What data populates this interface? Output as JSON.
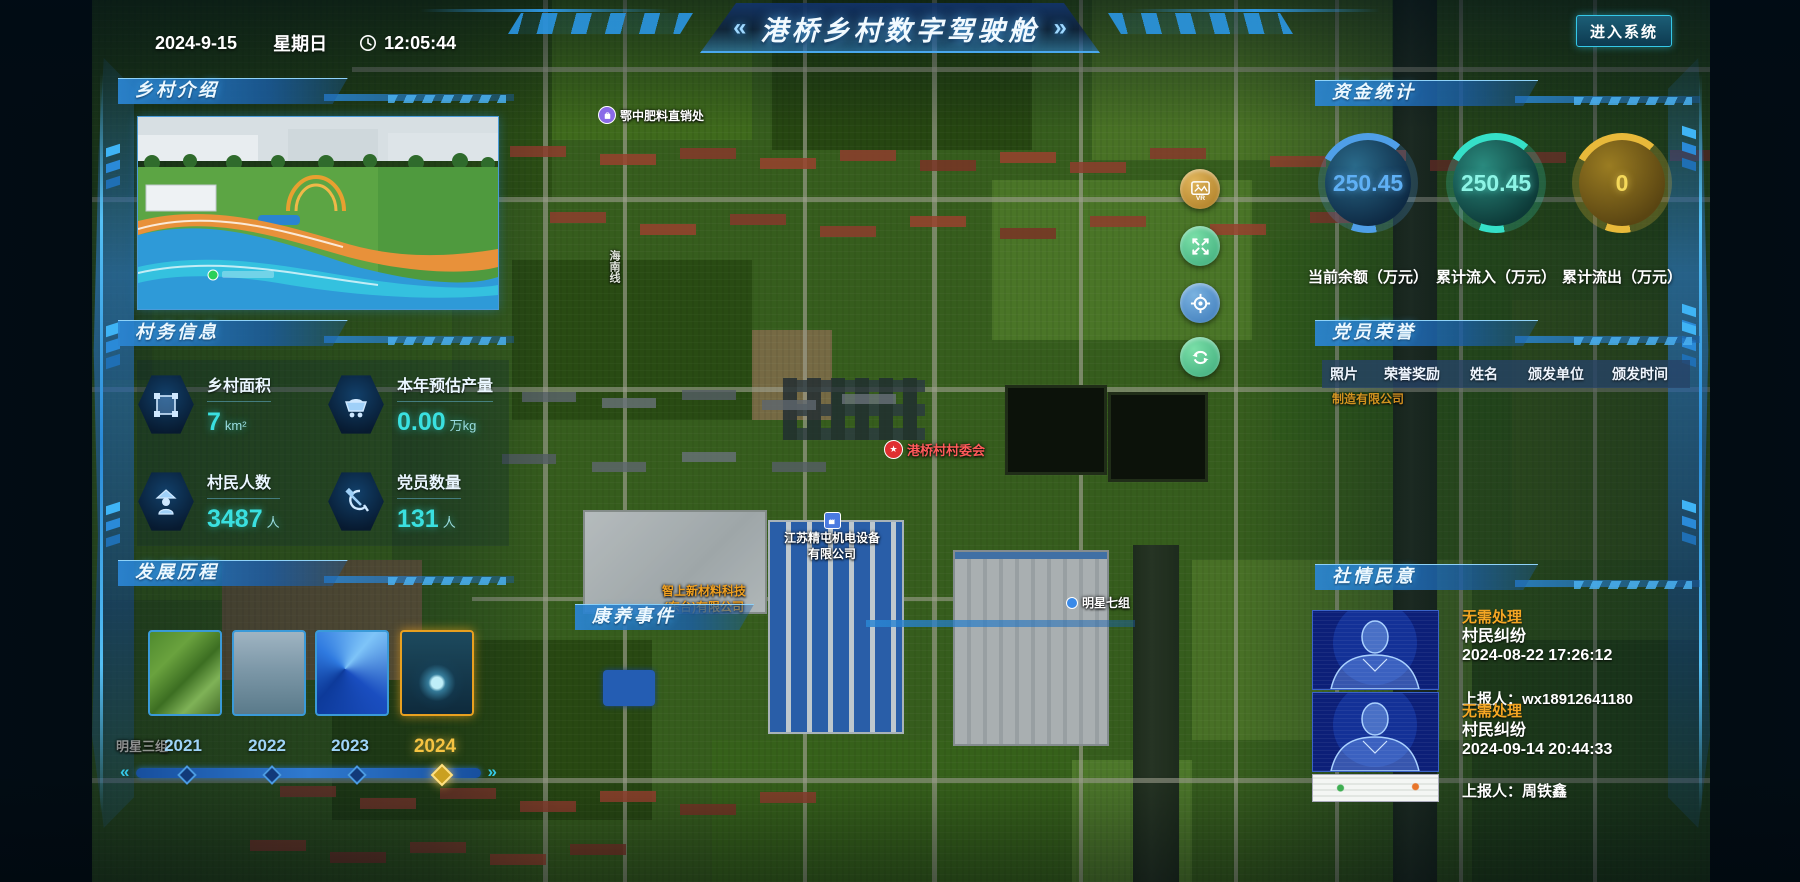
{
  "header": {
    "date": "2024-9-15",
    "weekday": "星期日",
    "time": "12:05:44",
    "left_arrow": "«",
    "title": "港桥乡村数字驾驶舱",
    "right_arrow": "»",
    "enter_button": "进入系统"
  },
  "intro": {
    "title": "乡村介绍"
  },
  "affairs": {
    "title": "村务信息",
    "stats": [
      {
        "icon": "area-icon",
        "label": "乡村面积",
        "value": "7",
        "unit": "km²"
      },
      {
        "icon": "cart-icon",
        "label": "本年预估产量",
        "value": "0.00",
        "unit": "万kg"
      },
      {
        "icon": "villager-icon",
        "label": "村民人数",
        "value": "3487",
        "unit": "人"
      },
      {
        "icon": "party-icon",
        "label": "党员数量",
        "value": "131",
        "unit": "人"
      }
    ]
  },
  "history": {
    "title": "发展历程",
    "items": [
      {
        "year": "2021"
      },
      {
        "year": "2022"
      },
      {
        "year": "2023"
      },
      {
        "year": "2024",
        "active": true
      }
    ]
  },
  "funds": {
    "title": "资金统计",
    "gauges": [
      {
        "value": "250.45",
        "label": "当前余额（万元）",
        "color": "#4f9fe8"
      },
      {
        "value": "250.45",
        "label": "累计流入（万元）",
        "color": "#35e0c8"
      },
      {
        "value": "0",
        "label": "累计流出（万元）",
        "color": "#e8b93a"
      }
    ]
  },
  "honors": {
    "title": "党员荣誉",
    "columns": [
      "照片",
      "荣誉奖励",
      "姓名",
      "颁发单位",
      "颁发时间"
    ]
  },
  "sentiment": {
    "title": "社情民意",
    "status_color": "#f5a623",
    "items": [
      {
        "status": "无需处理",
        "category": "村民纠纷",
        "time": "2024-08-22 17:26:12",
        "reporter": "上报人：wx18912641180"
      },
      {
        "status": "无需处理",
        "category": "村民纠纷",
        "time": "2024-09-14 20:44:33",
        "reporter": "上报人：周铁鑫"
      }
    ]
  },
  "health": {
    "title": "康养事件"
  },
  "map": {
    "pois": [
      {
        "text": "鄂中肥料直销处"
      },
      {
        "text": "港桥村村委会"
      },
      {
        "text": "江苏精屯机电设备",
        "text2": "有限公司"
      },
      {
        "text": "智上新材料科技",
        "text2": "(东台)有限公司"
      },
      {
        "text": "明星七组"
      },
      {
        "text": "明星三组"
      },
      {
        "text": "制造有限公司"
      },
      {
        "text": "海南线"
      }
    ]
  }
}
